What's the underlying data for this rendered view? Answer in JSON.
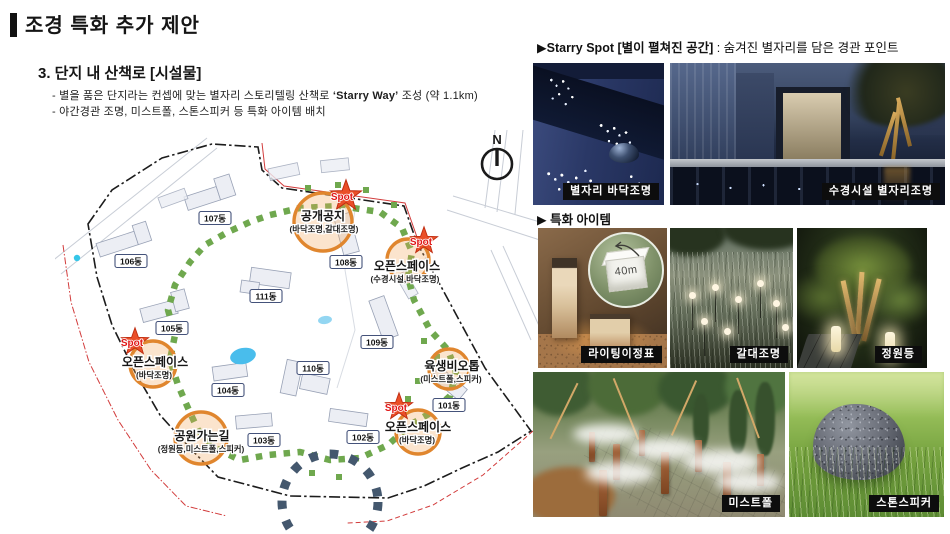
{
  "header": {
    "title": "조경 특화 추가 제안",
    "section": "3. 단지 내 산책로 [시설물]",
    "bullet1_pre": "- 별을 품은 단지라는 컨셉에 맞는 별자리 스토리텔링 산책로 ",
    "bullet1_em": "‘Starry Way’",
    "bullet1_post": " 조성 (약 1.1km)",
    "bullet2": "- 야간경관 조명, 미스트폴, 스톤스피커 등 특화 아이템 배치"
  },
  "map": {
    "compass_label": "N",
    "buildings": [
      {
        "label": "101동"
      },
      {
        "label": "102동"
      },
      {
        "label": "103동"
      },
      {
        "label": "104동"
      },
      {
        "label": "105동"
      },
      {
        "label": "106동"
      },
      {
        "label": "107동"
      },
      {
        "label": "108동"
      },
      {
        "label": "109동"
      },
      {
        "label": "110동"
      },
      {
        "label": "111동"
      }
    ],
    "spots": [
      {
        "title": "공개공지",
        "sub": "(바닥조명,갈대조명)",
        "badge": "Spot"
      },
      {
        "title": "오픈스페이스",
        "sub": "(수경시설,바닥조명)",
        "badge": "Spot"
      },
      {
        "title": "오픈스페이스",
        "sub": "(바닥조명)",
        "badge": "Spot"
      },
      {
        "title": "육생비오톱",
        "sub": "(미스트폴,스피커)",
        "badge": ""
      },
      {
        "title": "오픈스페이스",
        "sub": "(바닥조명)",
        "badge": "Spot"
      },
      {
        "title": "공원가는길",
        "sub": "(정원등,미스트폴,스피커)",
        "badge": ""
      }
    ],
    "colors": {
      "highlight_circle": "#e0862e",
      "star": "#ea4f28",
      "spot_text": "#e01515",
      "path_green": "#6fa84e",
      "loop_navy": "#44586e",
      "boundary_red": "#d23c3c",
      "boundary_black": "#1c1c1c"
    }
  },
  "right": {
    "starry_header_bold": "▶Starry Spot [별이 펼쳐진 공간]",
    "starry_header_rest": " : 숨겨진 별자리를 담은 경관 포인트",
    "item_header": "▶ 특화 아이템",
    "photos": {
      "constellation_floor": "별자리 바닥조명",
      "water_constellation": "수경시설 별자리조명",
      "lighting_signpost": "라이팅이정표",
      "reed_light": "갈대조명",
      "garden_light": "정원등",
      "mist_pole": "미스트폴",
      "stone_speaker": "스톤스피커"
    },
    "inset_distance": "40m"
  }
}
